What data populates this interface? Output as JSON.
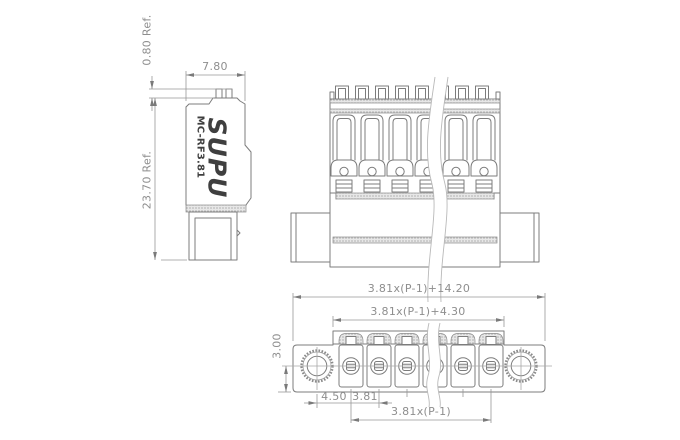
{
  "title": "MC-RF3.81 connector dimensional drawing",
  "brand": {
    "logo": "SUPU",
    "model": "MC-RF3.81"
  },
  "dimensions": {
    "top_ref": "0.80 Ref.",
    "width": "7.80",
    "height_ref": "23.70 Ref.",
    "overall": "3.81x(P-1)+14.20",
    "housing": "3.81x(P-1)+4.30",
    "hole_offset": "3.00",
    "edge_to_pin": "4.50",
    "pitch": "3.81",
    "pin_span": "3.81x(P-1)"
  },
  "colors": {
    "line": "#7c7c7c",
    "dimension": "#979797",
    "text": "#8e8e8e",
    "brand_text": "#3f3f3f",
    "background": "#ffffff"
  }
}
